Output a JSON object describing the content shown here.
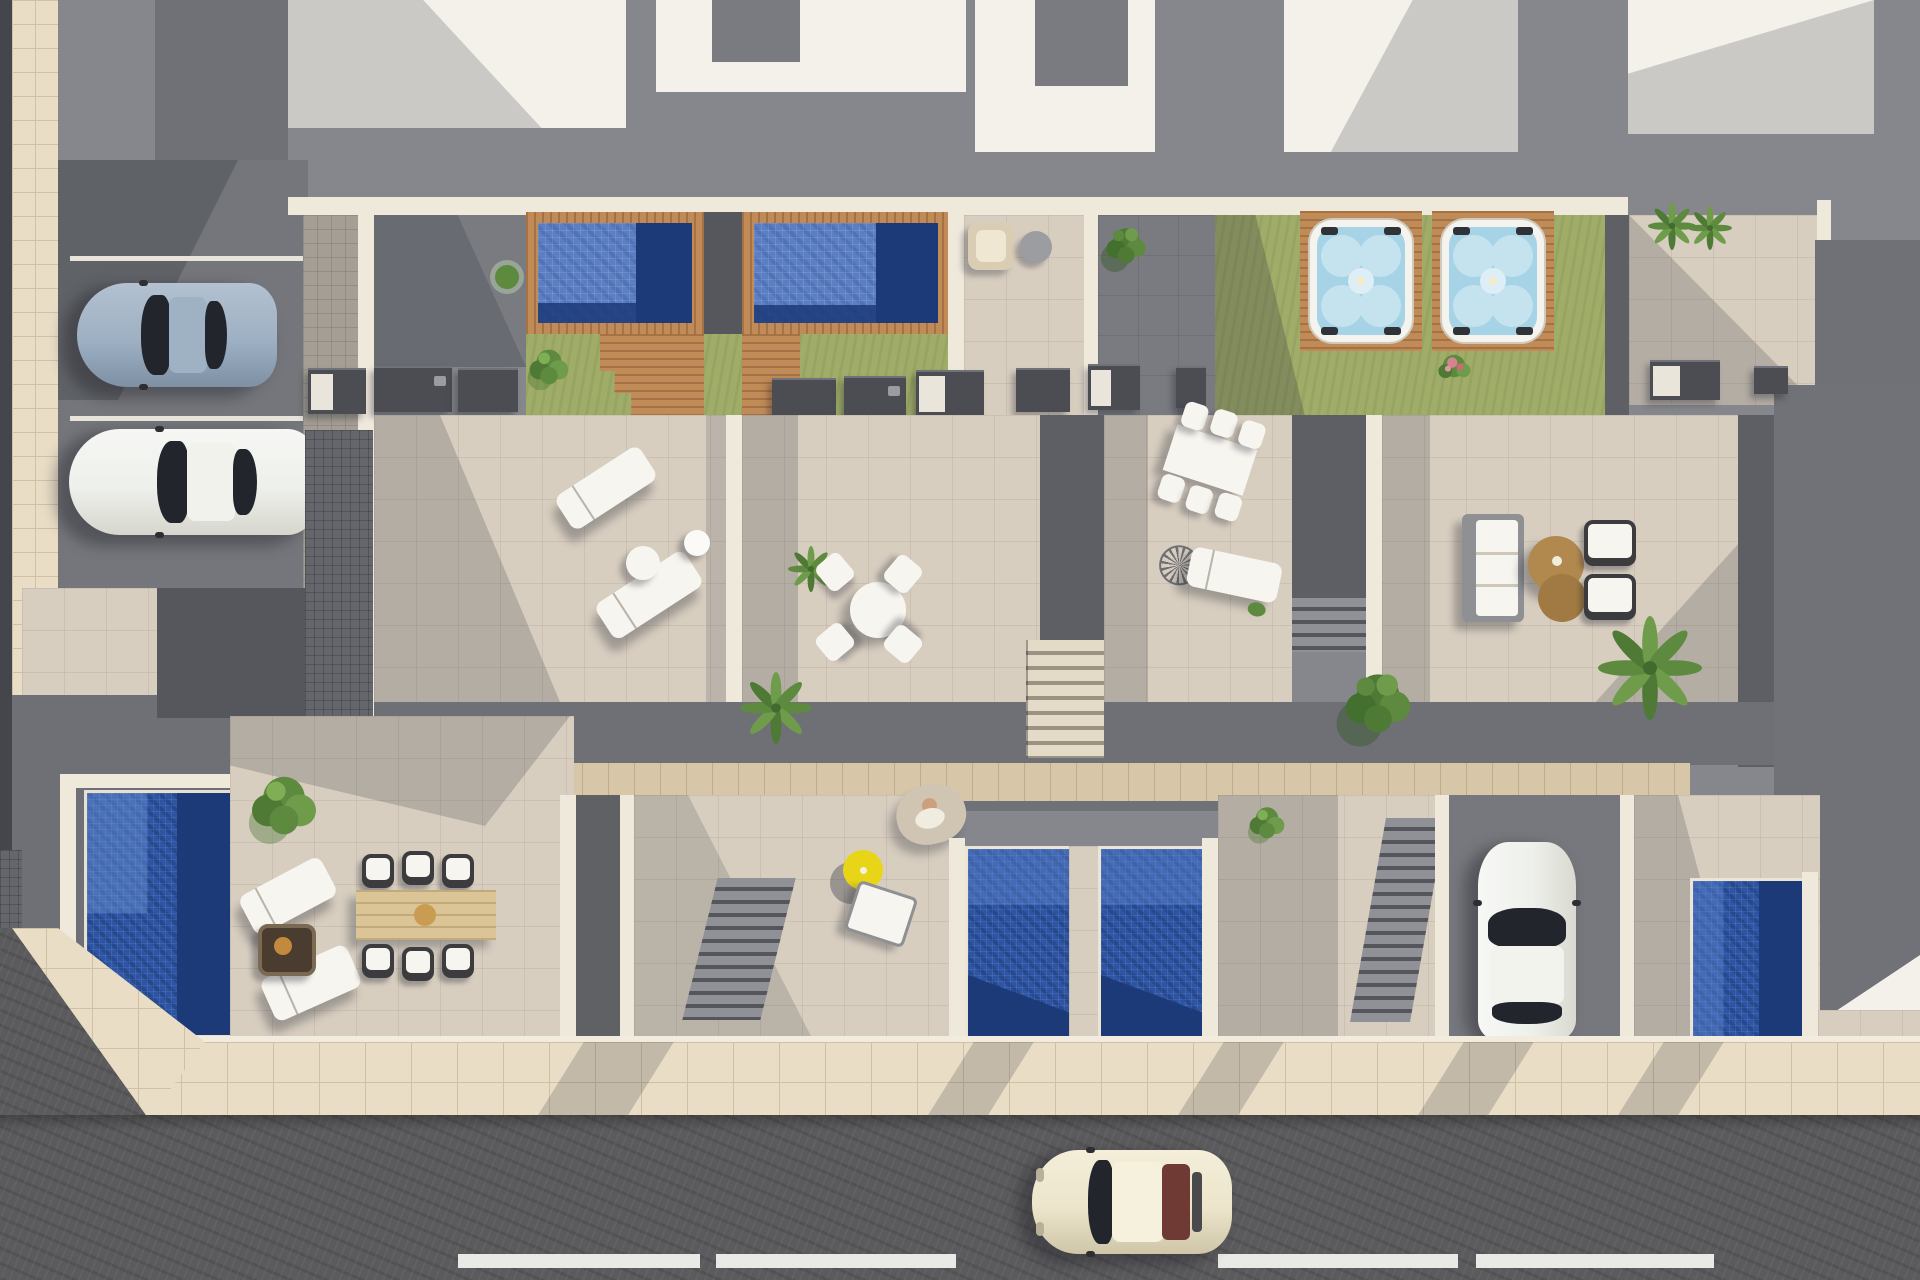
{
  "caption": "Aerial top-down 3D architectural rendering of a row of modern townhouses with white roofs, upper terraces with tiled pools and jacuzzis on lawns, beige tiled patios with outdoor furniture, lower-level gardens with plunge pools, a parking area with two cars, a driveway car, and a street with one cream car and dashed lane markings",
  "palette": {
    "wallGray": "#85878c",
    "wallDark": "#6f7176",
    "roofWhite": "#f3f1ea",
    "wallWhite": "#efe9dc",
    "terrace": "#d8cec0",
    "paverMid": "#797b80",
    "paverDark": "#5d5f65",
    "paverFine": "#64666c",
    "sidewalk": "#e9ddc6",
    "sidewalkLine": "#cfc0a6",
    "asphalt": "#5b5b5d",
    "lawn": "#a0ad68",
    "deckWood": "#c08b57",
    "walkWood": "#d8c6a8",
    "poolBlue": "#5b7fc4",
    "poolDeep": "#2d55a4",
    "poolNavy": "#1c3a78",
    "jacuzziWater": "#a7d3e6",
    "furnWhite": "#f7f5ef",
    "chairDark": "#3c3c3f",
    "tableWood": "#dbc495",
    "coffeeBrown": "#b1894e",
    "firepit": "#4a3c2e",
    "parasolYellow": "#e8d517",
    "carCream": "#ece5cb",
    "carBlueGray": "#9eb0c3",
    "carWhite": "#eef0ec",
    "glassDark": "#22262c",
    "rearWindowRed": "#6e3a33",
    "greenLeaf": "#5d8a3f",
    "greenDark": "#43702f",
    "pinkFlower": "#d4848c",
    "skin": "#caa07e",
    "shadow": "rgba(42,45,55,0.20)"
  },
  "inventory": {
    "vehicles": [
      {
        "name": "sports-car",
        "color": "blue-gray",
        "location": "parking-lot"
      },
      {
        "name": "car",
        "color": "white",
        "location": "parking-lot"
      },
      {
        "name": "car",
        "color": "white",
        "location": "driveway"
      },
      {
        "name": "classic-car",
        "color": "cream",
        "location": "street"
      }
    ],
    "pools": {
      "rooftop_tiled_pools": 2,
      "ground_level_pools": 4
    },
    "jacuzzis": 2,
    "sun_loungers": 6,
    "dining_sets": [
      {
        "type": "round-table-with-4-chairs",
        "location": "terrace-2"
      },
      {
        "type": "rectangular-table-with-6-chairs",
        "location": "terrace-3"
      },
      {
        "type": "wood-table-with-6-wicker-chairs",
        "location": "garden-1"
      }
    ],
    "lounge_set": {
      "sofa": 1,
      "armchairs": 2,
      "round_coffee_tables": 2,
      "location": "terrace-4"
    },
    "misc": [
      "yellow-parasol",
      "hanging-chair-with-person",
      "fire-pit",
      "outdoor-kitchen-counters",
      "palm-trees",
      "bushes",
      "flower-shrub"
    ],
    "street": {
      "lane_markings": "white dashes",
      "parking_bays": 3
    }
  }
}
